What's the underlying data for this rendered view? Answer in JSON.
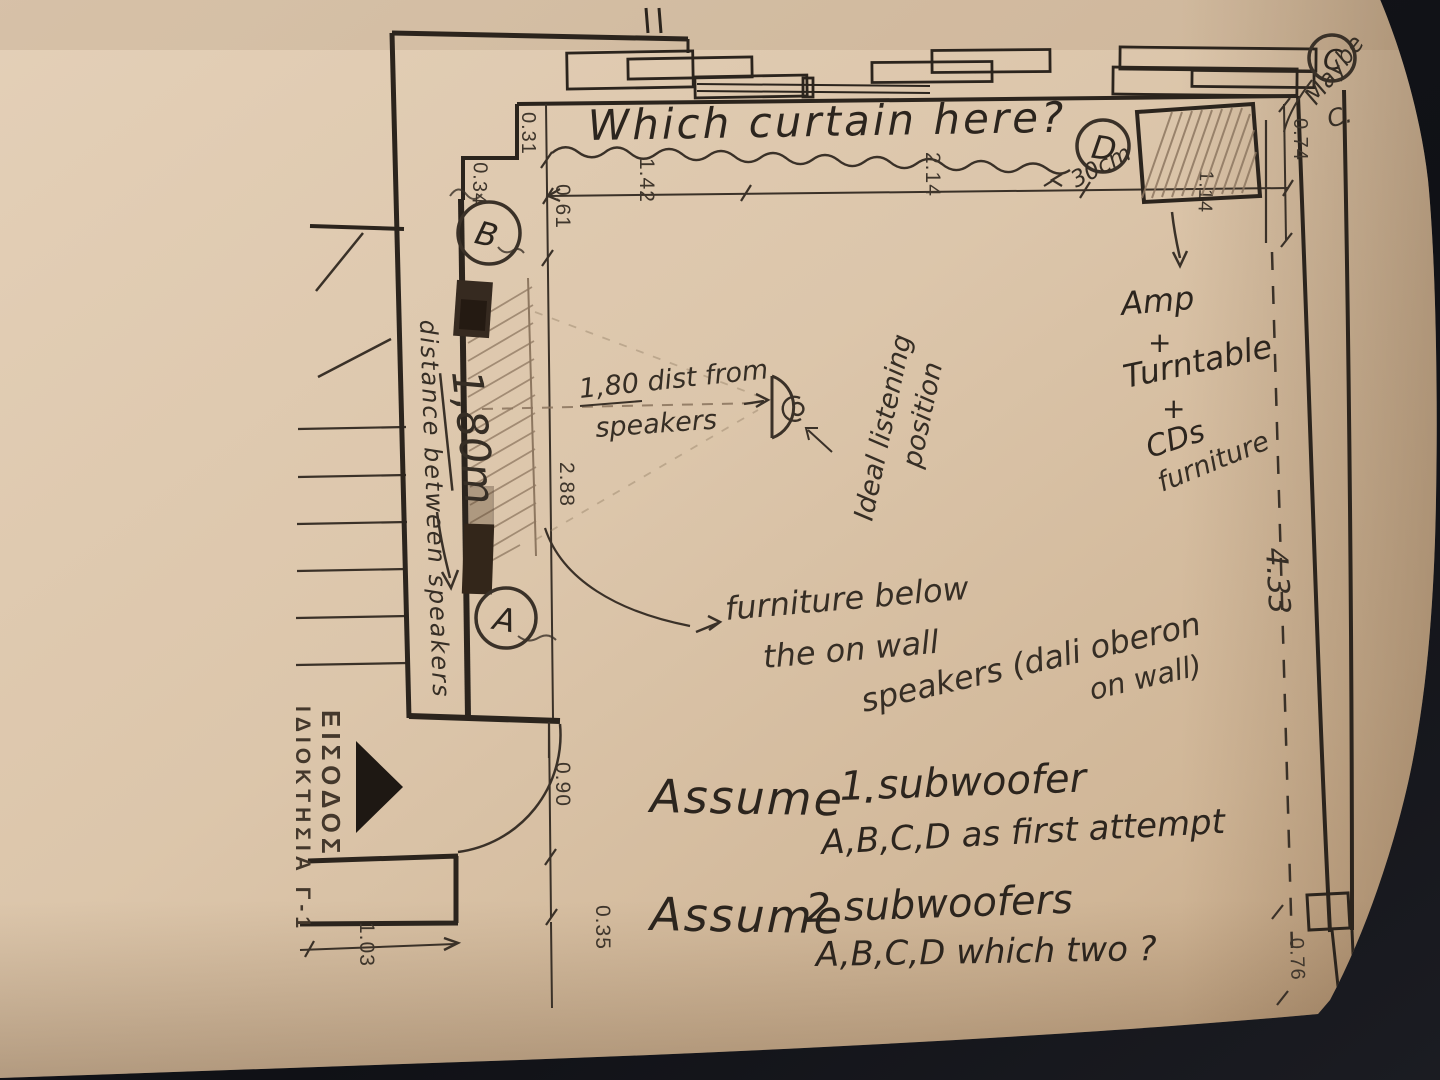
{
  "document": {
    "kind": "hand-drawn floor plan photo",
    "subject": "listening room speaker / subwoofer placement sketch"
  },
  "colors": {
    "paper": "#dcc6ab",
    "paper_edge": "#c1a586",
    "ink": "#2b241d",
    "pencil": "#8d7760",
    "background": "#101116"
  },
  "letters": {
    "a": "A",
    "b": "B",
    "c": "C",
    "d": "D"
  },
  "notes": {
    "curtain": "Which curtain here?",
    "maybe": {
      "word": "Maybe",
      "sub": "C."
    },
    "d_offset": "30cm",
    "dist": {
      "l1": "1,80 dist from",
      "l2": "speakers"
    },
    "ideal": {
      "l1": "Ideal listening",
      "l2": "position"
    },
    "amp": {
      "l1": "Amp",
      "l2": "+",
      "l3": "Turntable",
      "l4": "+",
      "l5": "CDs",
      "l6": "furniture"
    },
    "furn": {
      "l1": "furniture below",
      "l2": "the on wall",
      "l3": "speakers (dali oberon",
      "l4": "on wall)"
    },
    "between": {
      "text": "distance between speakers",
      "value": "1,80m"
    },
    "assume1": {
      "label": "Assume ·",
      "qty": "1 subwoofer",
      "detail": "A,B,C,D as first attempt"
    },
    "assume2": {
      "label": "Assume",
      "qty": "2 subwoofers",
      "detail": "A,B,C,D which two ?"
    },
    "entrance": {
      "l1": "ΕΙΣΟΔΟΣ",
      "l2": "ΙΔΙΟΚΤΗΣΙΑ Γ-1"
    }
  },
  "dims": {
    "d031": "0.31",
    "d034": "0.34",
    "d061": "0.61",
    "d142": "1.42",
    "d214": "2.14",
    "d074": "0.74",
    "d114": "1.14",
    "d288": "2.88",
    "d433": "4.33",
    "d090": "0.90",
    "d035": "0.35",
    "d103": "1.03",
    "d076": "0.76"
  }
}
